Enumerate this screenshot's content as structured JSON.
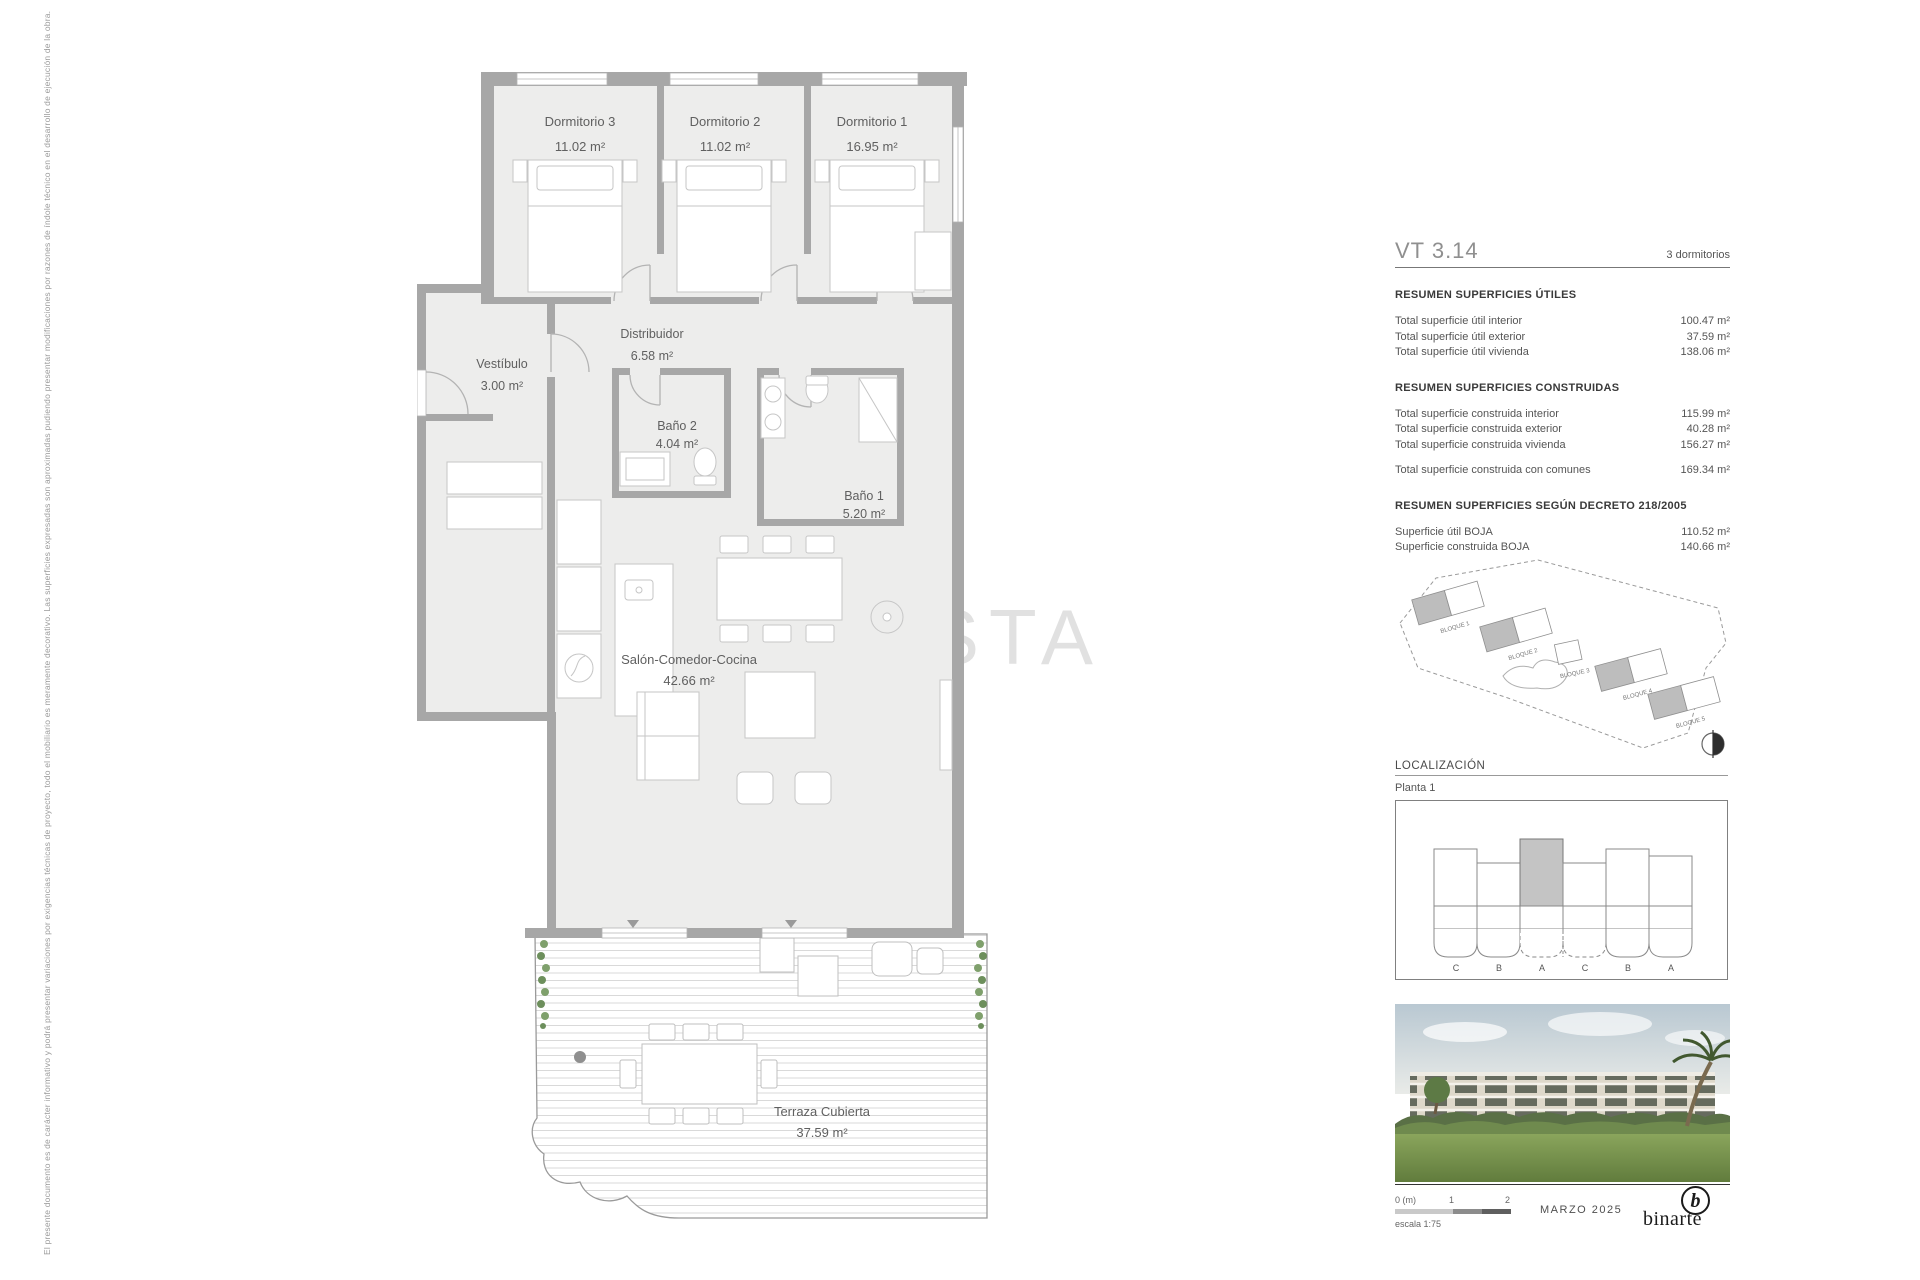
{
  "disclaimer": "El presente documento es de carácter informativo y podrá presentar variaciones por exigencias técnicas de proyecto, todo el mobiliario es meramente decorativo. Las superficies expresadas son aproximadas pudiendo presentar modificaciones por razones de índole técnico en el desarrollo de ejecución de la obra.",
  "watermark": "COSTA",
  "plan": {
    "rooms": [
      {
        "name": "Dormitorio 3",
        "area": "11.02 m²"
      },
      {
        "name": "Dormitorio 2",
        "area": "11.02 m²"
      },
      {
        "name": "Dormitorio 1",
        "area": "16.95 m²"
      },
      {
        "name": "Vestíbulo",
        "area": "3.00 m²"
      },
      {
        "name": "Distribuidor",
        "area": "6.58 m²"
      },
      {
        "name": "Baño 2",
        "area": "4.04 m²"
      },
      {
        "name": "Baño 1",
        "area": "5.20 m²"
      },
      {
        "name": "Salón-Comedor-Cocina",
        "area": "42.66 m²"
      },
      {
        "name": "Terraza Cubierta",
        "area": "37.59 m²"
      }
    ]
  },
  "panel": {
    "unit_code": "VT 3.14",
    "unit_type": "3 dormitorios",
    "sections": [
      {
        "title": "RESUMEN SUPERFICIES ÚTILES",
        "rows": [
          {
            "label": "Total superficie útil interior",
            "value": "100.47 m²"
          },
          {
            "label": "Total superficie útil exterior",
            "value": "37.59 m²"
          },
          {
            "label": "Total superficie útil vivienda",
            "value": "138.06 m²"
          }
        ]
      },
      {
        "title": "RESUMEN SUPERFICIES CONSTRUIDAS",
        "rows": [
          {
            "label": "Total superficie construida interior",
            "value": "115.99 m²"
          },
          {
            "label": "Total superficie construida exterior",
            "value": "40.28 m²"
          },
          {
            "label": "Total superficie construida vivienda",
            "value": "156.27 m²"
          }
        ],
        "extra_row": {
          "label": "Total superficie construida con comunes",
          "value": "169.34 m²"
        }
      },
      {
        "title": "RESUMEN SUPERFICIES SEGÚN DECRETO 218/2005",
        "rows": [
          {
            "label": "Superficie útil BOJA",
            "value": "110.52 m²"
          },
          {
            "label": "Superficie construida BOJA",
            "value": "140.66 m²"
          }
        ]
      }
    ],
    "site": {
      "blocks": [
        "BLOQUE 1",
        "BLOQUE 2",
        "BLOQUE 3",
        "BLOQUE 4",
        "BLOQUE 5"
      ]
    },
    "localization": {
      "title": "LOCALIZACIÓN",
      "floor": "Planta 1",
      "unit_letters": [
        "C",
        "B",
        "A",
        "C",
        "B",
        "A"
      ]
    },
    "footer": {
      "scale_start": "0 (m)",
      "scale_mid": "1",
      "scale_end": "2",
      "scale_label": "escala 1:75",
      "date": "MARZO 2025",
      "logo_text": "binarte"
    }
  }
}
